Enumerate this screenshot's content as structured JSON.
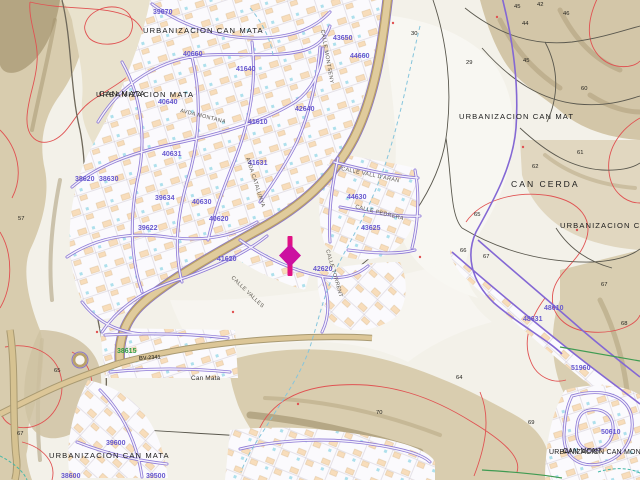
{
  "map_type": "cadastral-topographic-map",
  "labels": {
    "places": [
      "URBANIZACION  CAN    MATA",
      "URBANIZACION MATA",
      "CAN MATA",
      "URBANIZACION   CAN    MAT",
      "CAN CERDA",
      "URBANIZACION    CAN    C",
      "URBANIZACIÓN CAN MATA",
      "URBANIZACION CAN MONT",
      "CAN MONT",
      "Can Mata"
    ],
    "blocks": [
      "39670",
      "40660",
      "40640",
      "41640",
      "41610",
      "43650",
      "44660",
      "42640",
      "40631",
      "41631",
      "39634",
      "40630",
      "40620",
      "39622",
      "38620",
      "38630",
      "41620",
      "42620",
      "44630",
      "43625",
      "48610",
      "48631",
      "51960",
      "50610",
      "39600",
      "38600",
      "39500"
    ],
    "green_blocks": [
      "38615"
    ],
    "parcels": [
      "29",
      "30",
      "44",
      "45",
      "42",
      "46",
      "45",
      "60",
      "61",
      "62",
      "65",
      "66",
      "67",
      "67",
      "64",
      "68",
      "69",
      "70",
      "57",
      "65",
      "67"
    ],
    "streets": [
      "AVDA MONTANA",
      "CALLE MONTSENY",
      "CALLE VALL D'ARAN",
      "CALLE PEDRERA",
      "CALLE VALLES",
      "AVDA CATALUNYA",
      "CALLE TORRENT"
    ],
    "roads": [
      "BV-2341"
    ]
  },
  "marker": {
    "name": "selected-location",
    "bar": "#e01184",
    "fill": "#cc10a0",
    "outline": "#2f2fd4"
  },
  "colors": {
    "background": "#f3f1e9",
    "terrain": "#d8ccae",
    "contour_red": "#e05252",
    "street_violet": "#8d79d6",
    "boundary_violet": "#8468d4",
    "block_number": "#6758cf",
    "green_number": "#2f9e46",
    "road_fill": "#dcc697",
    "water_dash": "#86c5dc",
    "green_path": "#3f9b52",
    "building": "#f8ddbb"
  }
}
